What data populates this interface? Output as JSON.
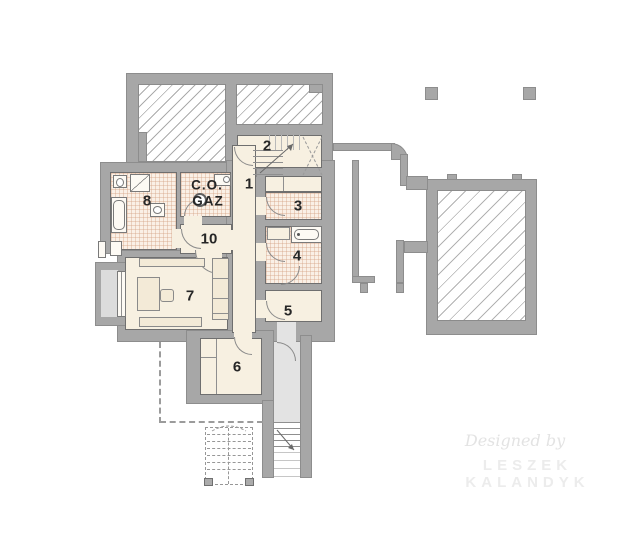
{
  "plan_title": "basement floor plan",
  "rooms": [
    {
      "id": "room-1",
      "number": "1"
    },
    {
      "id": "room-2",
      "number": "2"
    },
    {
      "id": "room-3",
      "number": "3"
    },
    {
      "id": "room-4",
      "number": "4"
    },
    {
      "id": "room-5",
      "number": "5"
    },
    {
      "id": "room-6",
      "number": "6"
    },
    {
      "id": "room-7",
      "number": "7"
    },
    {
      "id": "room-8",
      "number": "8"
    },
    {
      "id": "room-10",
      "number": "10"
    }
  ],
  "boiler_room": {
    "label_line1": "C.O.",
    "label_line2": "GAZ"
  },
  "watermark": {
    "script": "Designed by",
    "name": "LESZEK KALANDYK"
  },
  "colors": {
    "wall": "#a7a7a7",
    "floor_cream": "#f7f0e1",
    "floor_tile": "#faf0e6",
    "exterior": "#e3e3e3",
    "hatch_line": "#ababab",
    "label_text": "#262626",
    "watermark": "#e9e9e9"
  }
}
